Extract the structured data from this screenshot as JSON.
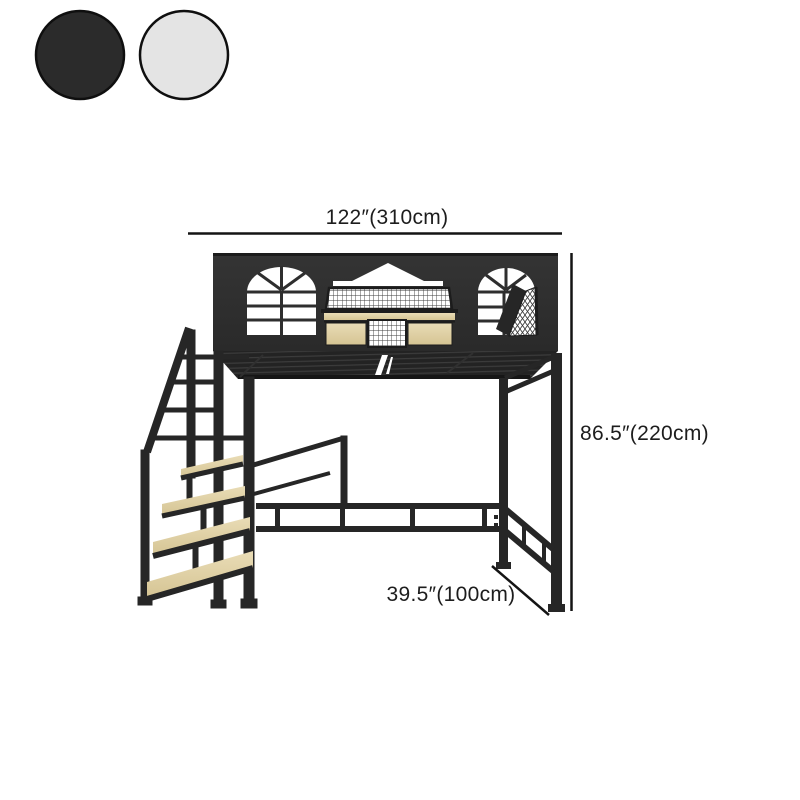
{
  "page": {
    "background": "#ffffff",
    "content": "loft bed product dimension diagram"
  },
  "color_swatches": {
    "items": [
      {
        "label": "black",
        "color": "#2b2b2b",
        "border": "#0f0f0f"
      },
      {
        "label": "light-gray",
        "color": "#e4e4e4",
        "border": "#0f0f0f"
      }
    ]
  },
  "diagram": {
    "product": "black metal loft bed with house-shaped guard, windows and staircase shelf",
    "dimension_labels": {
      "width": "122″(310cm)",
      "height": "86.5″(220cm)",
      "depth": "39.5″(100cm)"
    },
    "colors": {
      "frame": "#262626",
      "facade": "#2f2f2f",
      "wood": "#e0d3ab",
      "dimension_line": "#141414",
      "text": "#1d1d1d"
    }
  }
}
